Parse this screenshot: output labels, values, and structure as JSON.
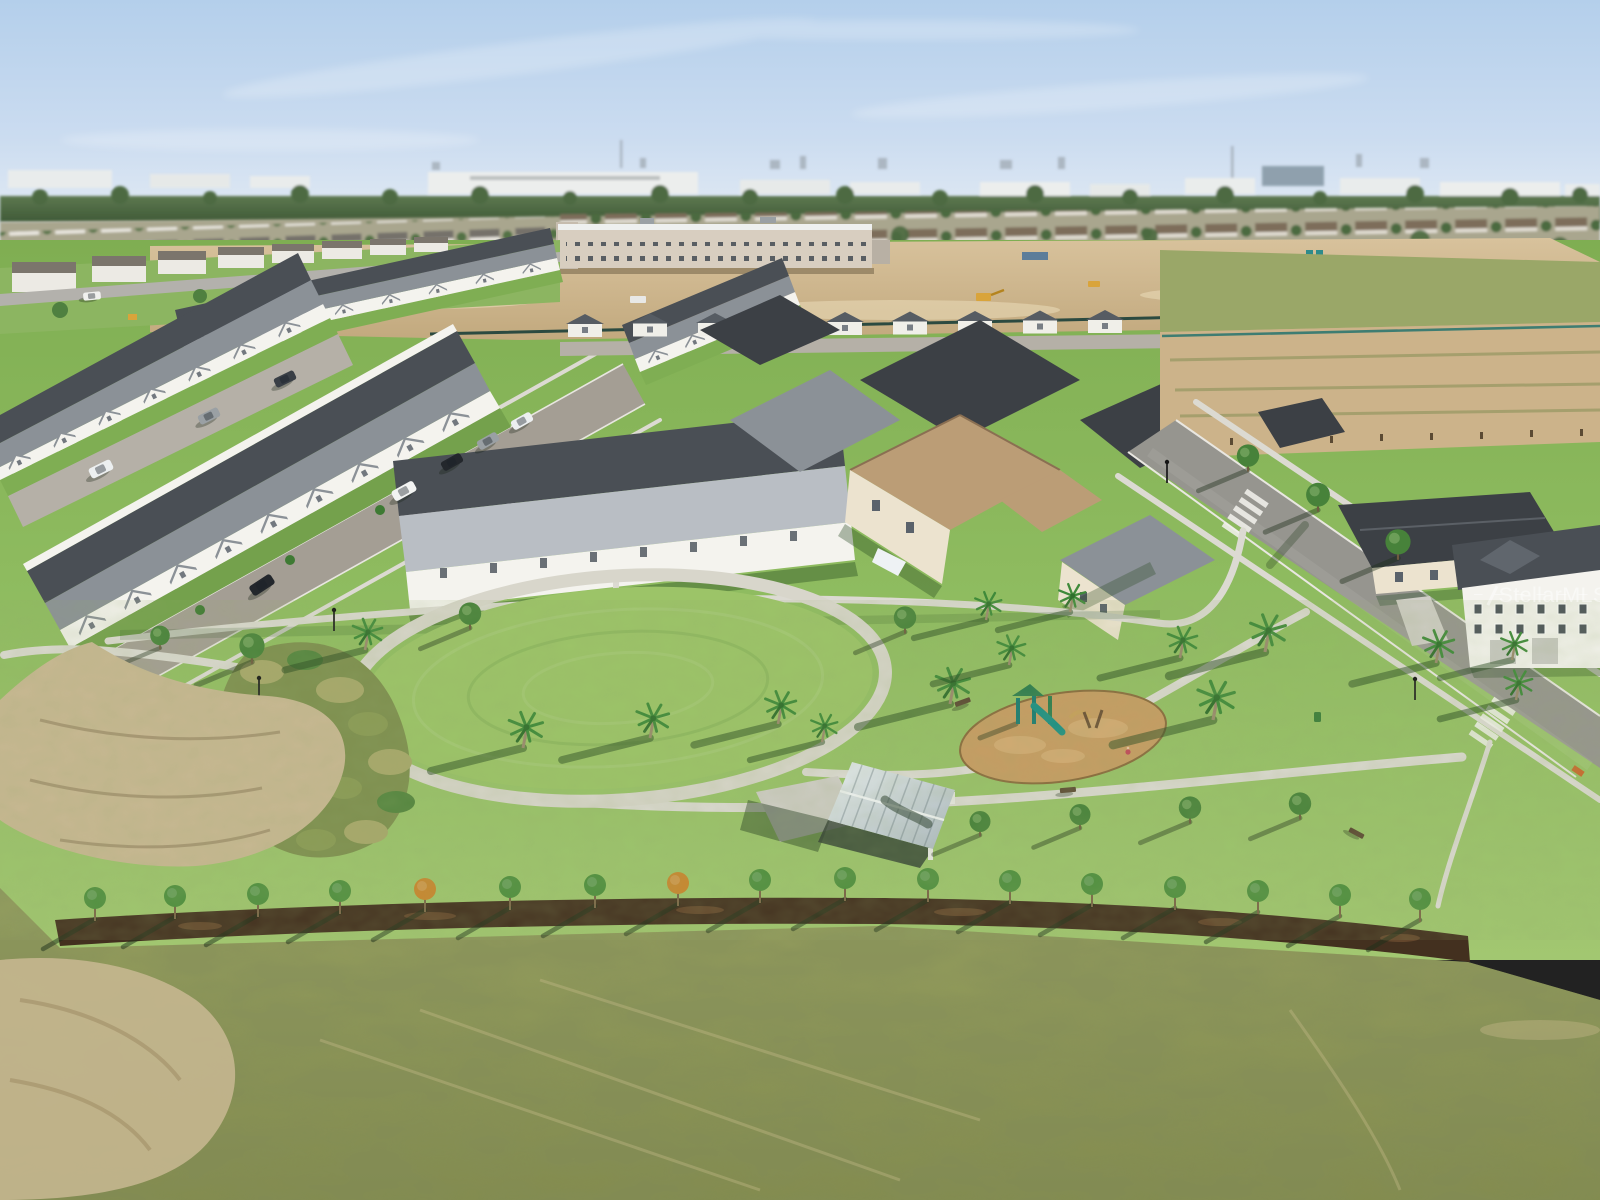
{
  "watermark": {
    "text": "StellarMLS",
    "opacity": 0.5,
    "color": "#ffffff"
  },
  "scene": {
    "type": "aerial-drone-photo",
    "setting": "new-construction suburban master-planned community",
    "lighting": "low sun from the east casting long shadows toward the west",
    "sky_condition": "clear blue with thin cirrus haze",
    "elements": [
      "sky",
      "horizon-skyline",
      "distant-tree-line",
      "distant-suburbs",
      "school-under-construction",
      "construction-dirt-staging",
      "construction-machinery",
      "townhouse-rows",
      "garage-alley",
      "residential-street",
      "parked-cars",
      "single-family-homes",
      "right-road",
      "crosswalks",
      "street-lamps",
      "central-park",
      "oval-lawn",
      "ring-path",
      "park-paths",
      "ornamental-grass-bed",
      "picnic-pavilion",
      "playground",
      "palm-trees",
      "park-benches",
      "trash-can",
      "mulch-planting-strip",
      "young-tree-row",
      "open-grass-field",
      "sand-patches"
    ]
  },
  "palette": {
    "sky_top": "#b4cfeb",
    "sky_mid": "#cbdcf0",
    "sky_horizon": "#e9eff5",
    "distant_tree": "#55714a",
    "distant_tree_dark": "#3f5a37",
    "distant_ground": "#a9a68e",
    "distant_wall": "#e9ecec",
    "distant_roof_brown": "#7d6d5a",
    "distant_roof_gray": "#75716a",
    "distant_blue_building": "#8fa0ad",
    "dirt": "#ccb38a",
    "dirt_light": "#dcc9a4",
    "sand": "#c9b893",
    "school_wall": "#d8cec0",
    "machine_yellow": "#d9a43b",
    "grass_bright": "#8cb561",
    "grass_park": "#8aba5e",
    "grass_strip": "#7fae53",
    "lawn_oval": "#9cc468",
    "field": "#99a260",
    "field_dark": "#878f4e",
    "asphalt": "#a49e94",
    "asphalt_new": "#96958f",
    "alley": "#b5b0a7",
    "sidewalk": "#dcdad2",
    "concrete": "#cfcdc6",
    "roof_dark": "#4a4f55",
    "roof_charcoal": "#3c4045",
    "roof_mid": "#8b9197",
    "roof_light": "#b9bec4",
    "roof_brown": "#bb9d76",
    "wall_white": "#f4f3ee",
    "wall_cream": "#ece3cf",
    "mulch": "#43301f",
    "mulch_light": "#6b4c2f",
    "play_mulch": "#c89c63",
    "play_teal": "#1a7f78",
    "play_green": "#2e7d4f",
    "pav_roof_light": "#e8eef1",
    "pav_roof_dark": "#aebac3",
    "palm_green": "#3f8a3a",
    "palm_trunk": "#9a8a6d",
    "tree_green": "#4f8f3f",
    "tree_amber": "#c9872f"
  }
}
